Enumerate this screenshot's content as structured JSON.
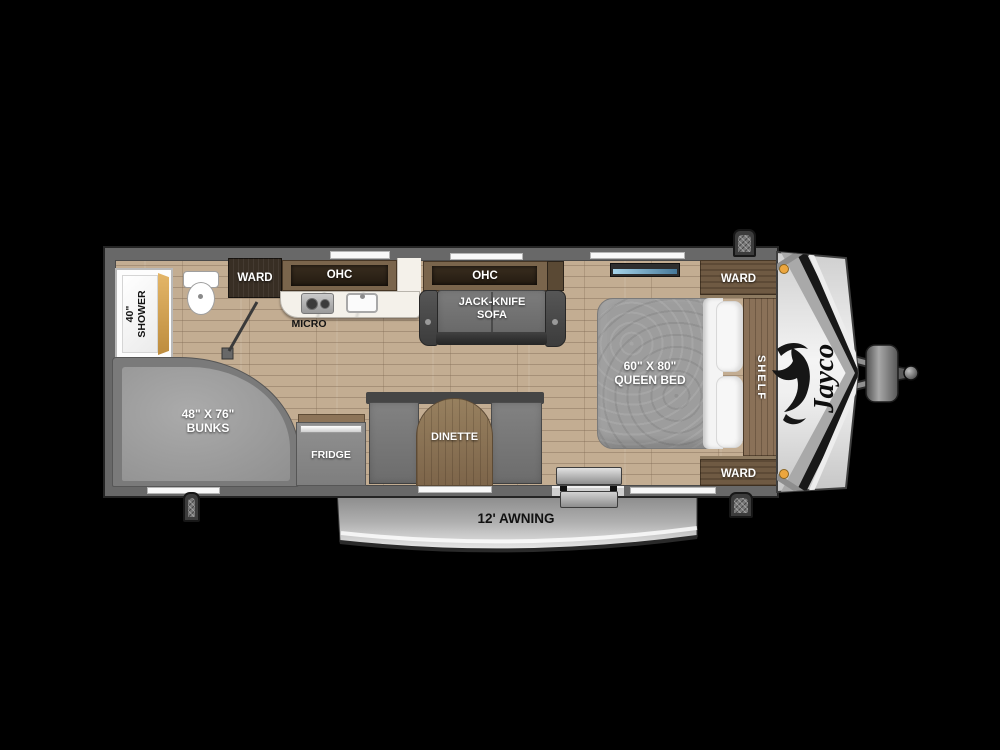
{
  "floorplan": {
    "brand": "Jayco",
    "labels": {
      "shower_line1": "40\"",
      "shower_line2": "SHOWER",
      "ward_rear": "WARD",
      "ohc_kitchen": "OHC",
      "micro": "MICRO",
      "ohc_living": "OHC",
      "sofa_line1": "JACK-KNIFE",
      "sofa_line2": "SOFA",
      "bunks_line1": "48\" X 76\"",
      "bunks_line2": "BUNKS",
      "fridge": "FRIDGE",
      "dinette": "DINETTE",
      "queen_line1": "60\" X 80\"",
      "queen_line2": "QUEEN BED",
      "ward_front_top": "WARD",
      "shelf": "SHELF",
      "ward_front_bottom": "WARD",
      "awning": "12' AWNING"
    },
    "colors": {
      "background": "#000000",
      "wall_gray": "#686868",
      "floor_wood": "#c3ad92",
      "cabinet_brown": "#6f5a43",
      "upholstery_gray": "#7d7d7d",
      "cap_silver": "#e8e8e8",
      "marker_orange": "#eca63e"
    }
  }
}
